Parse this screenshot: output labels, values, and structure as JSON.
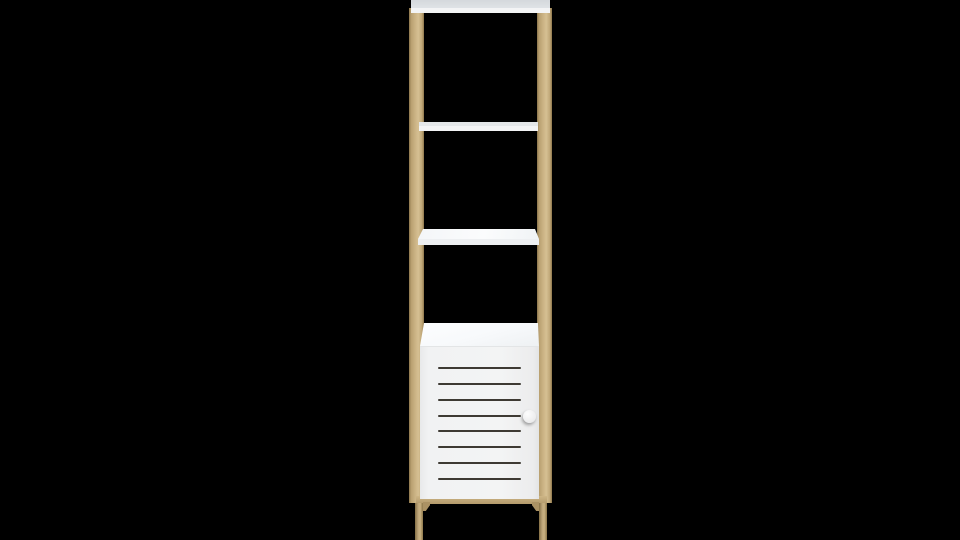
{
  "scene": {
    "description": "3D product render on a solid black background: a tall, narrow ladder-style shelving tower with a light birch-wood frame, a white top shelf, two white middle shelves, and a white base cabinet with a horizontal louvered door and a small round knob, standing on slim wooden legs joined by a wooden rail",
    "background_color": "#000000"
  },
  "furniture": {
    "shelf_count": 3,
    "slat_count": 8,
    "knob_side": "right",
    "colors": {
      "background": "#000000",
      "wood-light": "#d6c093",
      "wood-mid": "#c9b182",
      "wood-dark": "#8d774b",
      "shelf-white": "#f3f4f5",
      "shelf-top-gray": "#dfe3e6",
      "cabinet-white": "#f1f2f3",
      "cabinet-top-white": "#fdfeff",
      "slat": "#3e3a33",
      "knob": "#ececed"
    },
    "parts": [
      {
        "name": "left-post",
        "material": "wood"
      },
      {
        "name": "right-post",
        "material": "wood"
      },
      {
        "name": "top-shelf",
        "material": "white board"
      },
      {
        "name": "middle-shelf-upper",
        "material": "white board"
      },
      {
        "name": "middle-shelf-lower",
        "material": "white board"
      },
      {
        "name": "base-cabinet",
        "material": "white board"
      },
      {
        "name": "louvered-door",
        "slats": 8
      },
      {
        "name": "door-knob",
        "shape": "round"
      },
      {
        "name": "bottom-rail",
        "material": "wood"
      },
      {
        "name": "left-leg",
        "material": "wood"
      },
      {
        "name": "right-leg",
        "material": "wood"
      }
    ]
  }
}
